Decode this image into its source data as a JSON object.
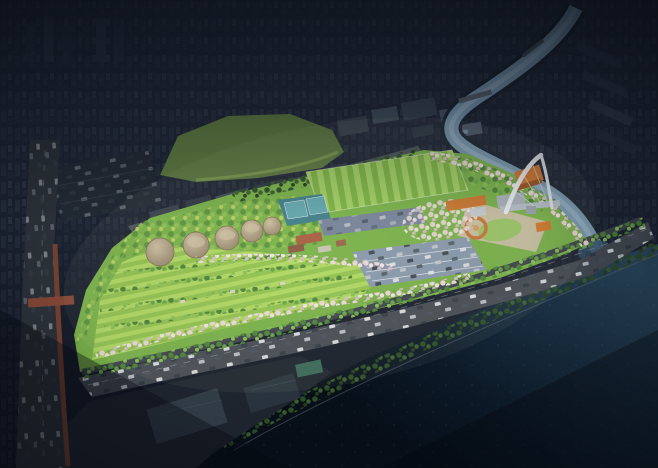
{
  "scene": {
    "type": "aerial-architectural-rendering",
    "time_of_day": "dusk-spotlight",
    "description": "Bird's-eye rendering of a riverside park redevelopment: the park is brightly lit while the surrounding dense city is darkened. A tributary stream winds from the city and joins a dark river; a waterfront expressway with traffic runs between the park and the water.",
    "landmarks": [
      "darkened city skyline",
      "grass hill",
      "railway corridor",
      "tributary stream",
      "striped sports field",
      "tennis courts",
      "community garden meadow",
      "round digester tanks",
      "cherry blossom promenade",
      "white arch monument",
      "orange pavilion buildings",
      "visitor center cluster",
      "parking lots",
      "river confluence",
      "waterfront expressway",
      "brick boundary wall",
      "industrial sheds",
      "river"
    ]
  },
  "colors": {
    "nightTop": "#262e3d",
    "nightMid": "#1b2230",
    "nightLow": "#121823",
    "cityBlockA": "#2c3544",
    "cityBlockB": "#343e4e",
    "cityBlockC": "#27303e",
    "citySlab": "#303a4a",
    "cityTower": "#2d3747",
    "litA": "#3a4450",
    "litB": "#424e5c",
    "litC": "#37424e",
    "litD": "#4a5662",
    "litE": "#556274",
    "roofBlue": "#6f8aa0",
    "hill": "#5f7b41",
    "hillLit": "#82a052",
    "rail": "#4e555e",
    "track": "#353c45",
    "train": "#ccd2d8",
    "waterA": "#2c4a61",
    "waterB": "#1a3042",
    "waterC": "#0c1a28",
    "waterD": "#070f19",
    "streamBank": "#1c2733",
    "stream": "#7b9cb4",
    "streamHi": "#a9c2d4",
    "confluence": "#34536b",
    "bridge": "#5a6571",
    "highway": "#474d55",
    "frontage": "#3e444c",
    "laneLine": "#e8ecef",
    "leftRoad": "#2e343b",
    "brickWall": "#7a4433",
    "pedBridge": "#8a4a38",
    "industrial": "#1f2630",
    "shedA": "#333e48",
    "shedB": "#2b353f",
    "shedTeal": "#3c6a5a",
    "park": "#7ab34a",
    "meadowA": "#aed763",
    "meadowB": "#93c251",
    "pitchA": "#7fb545",
    "pitchB": "#a3d166",
    "pitchLine": "#dcebc8",
    "treeA": "#4c8338",
    "treeB": "#69a546",
    "treeC": "#86bf55",
    "treeDarkA": "#2e4f26",
    "treeDarkB": "#3a612e",
    "treeDarkC": "#24401d",
    "treeYelA": "#5b9340",
    "treeYelB": "#8fbf54",
    "treeYelC": "#bccf63",
    "blossomA": "#ecd7da",
    "blossomB": "#f2e5e5",
    "blossomC": "#d9bcc6",
    "blossomSpeck": "#7fa04f",
    "courtTeal": "#417f8b",
    "courtInner": "#63a7ae",
    "courtLine": "#e8f0f2",
    "parkingN": "#76839a",
    "parkingSE": "#8a99ac",
    "parkLine": "#eef1f4",
    "tankHi": "#cdbfa2",
    "tankLo": "#97876c",
    "tankEdge": "#7e7058",
    "roofRed": "#a85f43",
    "roofBrown": "#8a5a42",
    "wallWhite": "#c9c2b2",
    "roofTan": "#97664a",
    "plaza": "#ccc0a6",
    "plazaLawn": "#9bc468",
    "spiral": "#c4763a",
    "orange": "#d2752f",
    "orangeDark": "#9c5420",
    "grayBldg": "#a9b2bb",
    "whiteBldg": "#c6ccd2",
    "archA": "#e9eef3",
    "archB": "#dfe6ec",
    "cable": "#cdd6de",
    "deck": "#b6c0ca",
    "pier": "#99a4ae",
    "carA": "#e8ebee",
    "carB": "#323c46",
    "carC": "#c7ccd2",
    "carD": "#4a5560",
    "sparkle": "#9fc3d8",
    "glow": "#fff8e0"
  }
}
